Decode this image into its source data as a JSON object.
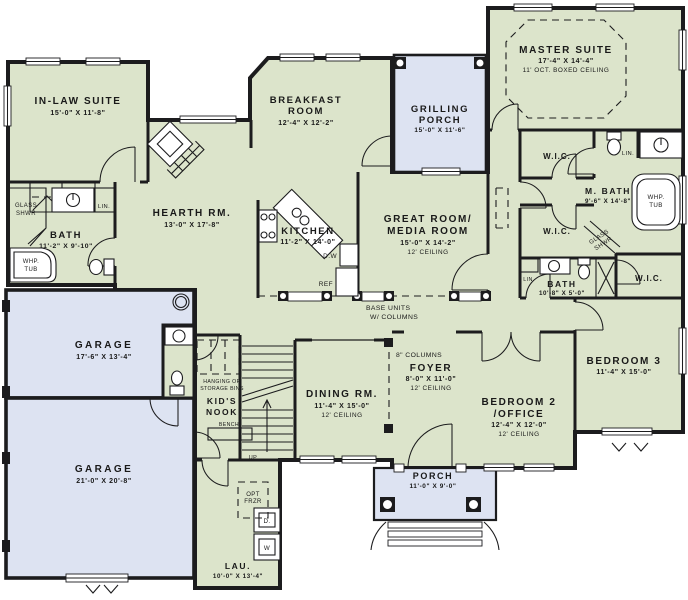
{
  "plan": {
    "type": "single-story house floor plan",
    "colors": {
      "room_fill": "#dce4cb",
      "garage_porch_fill": "#dde3f2",
      "wall": "#1c1c1e",
      "background": "#ffffff"
    }
  },
  "rooms": {
    "in_law": {
      "name": "IN-LAW SUITE",
      "dims": "15'-0\" X 11'-8\""
    },
    "inlaw_bath": {
      "name": "BATH",
      "dims": "11'-2\" X 9'-10\""
    },
    "hearth": {
      "name": "HEARTH RM.",
      "dims": "13'-0\" X 17'-8\""
    },
    "breakfast": {
      "name1": "BREAKFAST",
      "name2": "ROOM",
      "dims": "12'-4\" X 12'-2\""
    },
    "grilling_porch": {
      "name1": "GRILLING",
      "name2": "PORCH",
      "dims": "15'-0\" X 11'-6\""
    },
    "master": {
      "name": "MASTER SUITE",
      "dims": "17'-4\" X 14'-4\"",
      "note": "11' OCT. BOXED CEILING"
    },
    "kitchen": {
      "name": "KITCHEN",
      "dims": "11'-2\" X 14'-0\""
    },
    "great_room": {
      "name1": "GREAT ROOM/",
      "name2": "MEDIA ROOM",
      "dims": "15'-0\" X 14'-2\"",
      "note": "12' CEILING"
    },
    "master_bath": {
      "name": "M. BATH",
      "dims": "9'-6\" X 14'-8\""
    },
    "hall_bath": {
      "name": "BATH",
      "dims": "10'-8\" X 5'-0\""
    },
    "bedroom3": {
      "name": "BEDROOM 3",
      "dims": "11'-4\" X 15'-0\""
    },
    "garage1": {
      "name": "GARAGE",
      "dims": "17'-6\" X 13'-4\""
    },
    "garage2": {
      "name": "GARAGE",
      "dims": "21'-0\" X 20'-8\""
    },
    "kids_nook": {
      "name1": "KID'S",
      "name2": "NOOK"
    },
    "dining": {
      "name": "DINING RM.",
      "dims": "11'-4\" X 15'-0\"",
      "note": "12' CEILING"
    },
    "foyer": {
      "name": "FOYER",
      "dims": "8'-0\" X 11'-0\"",
      "note": "12' CEILING"
    },
    "bedroom2": {
      "name1": "BEDROOM 2",
      "name2": "/OFFICE",
      "dims": "12'-4\" X 12'-0\"",
      "note": "12' CEILING"
    },
    "porch": {
      "name": "PORCH",
      "dims": "11'-0\" X 9'-0\""
    },
    "laundry": {
      "name": "LAU.",
      "dims": "10'-0\" X 13'-4\""
    }
  },
  "labels": {
    "glass": "GLASS",
    "shwr": "SHWR",
    "whp": "WHP.",
    "tub": "TUB",
    "lin": "LIN.",
    "wic": "W.I.C.",
    "base_units1": "BASE UNITS",
    "base_units2": "W/ COLUMNS",
    "columns8": "8\" COLUMNS",
    "dw": "D.W",
    "ref": "REF",
    "hang1": "HANGING OR",
    "hang2": "STORAGE BINS",
    "bench": "BENCH",
    "up": "UP",
    "opt": "OPT",
    "frzr": "FRZR",
    "dryer": "D.",
    "washer": "W"
  }
}
